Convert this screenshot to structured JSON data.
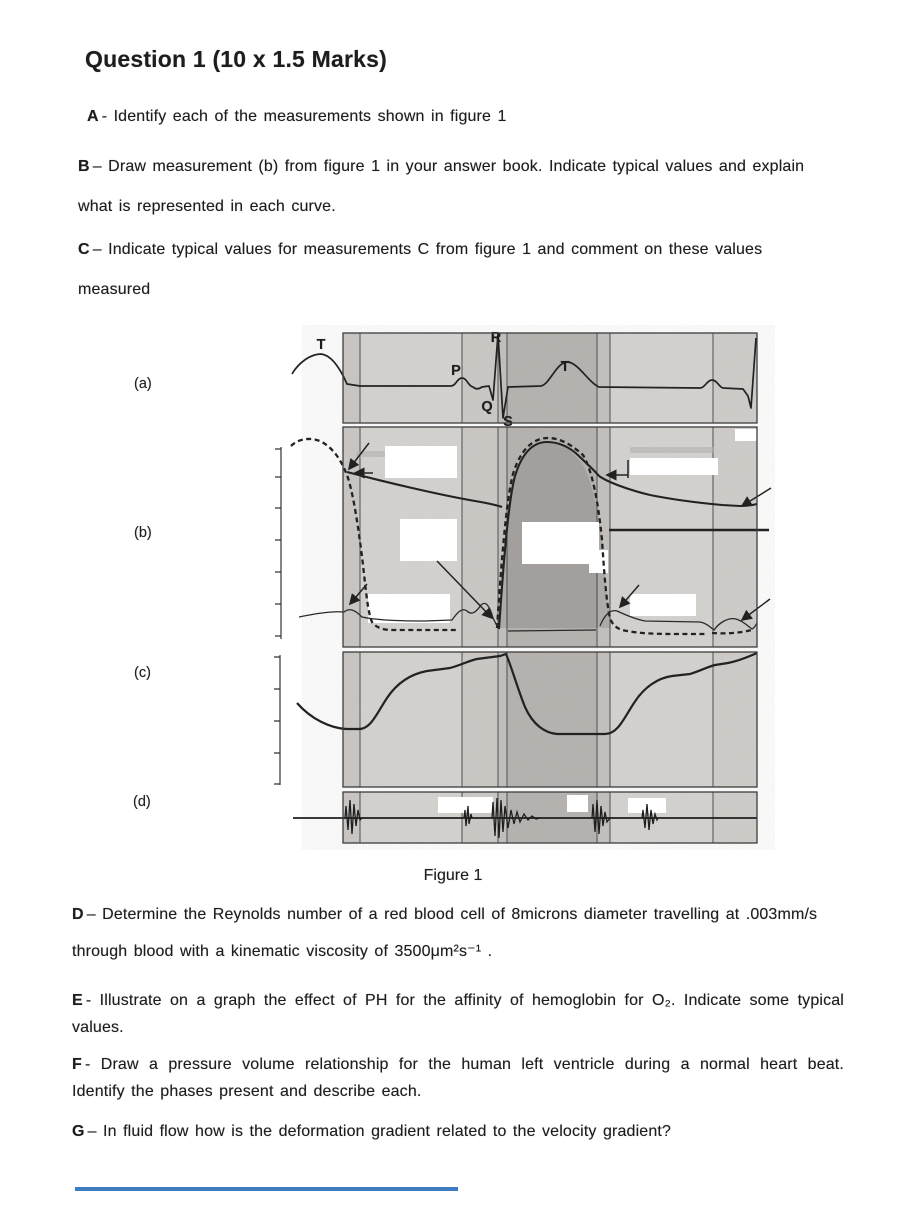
{
  "doc": {
    "title": "Question 1 (10 x 1.5 Marks)",
    "parts": {
      "a": {
        "label": "A",
        "text": "- Identify each of the measurements shown in figure 1"
      },
      "b": {
        "label": "B",
        "line1": "– Draw measurement (b) from figure 1 in your answer book. Indicate typical values and explain",
        "line2": "what is represented in each curve."
      },
      "c": {
        "label": "C",
        "line1": "– Indicate typical values for measurements C from figure 1 and comment on these values",
        "line2": "measured"
      },
      "d": {
        "label": "D",
        "line1": "– Determine the Reynolds number of a red blood cell of 8microns diameter travelling at .003mm/s",
        "line2": "through blood with a kinematic viscosity of 3500μm²s⁻¹ ."
      },
      "e": {
        "label": "E",
        "line1": "- Illustrate on a graph the effect of PH for the affinity of hemoglobin for O₂. Indicate some typical",
        "line2": "values."
      },
      "f": {
        "label": "F",
        "line1": "- Draw a pressure volume relationship for the human left ventricle during a normal heart beat.",
        "line2": "Identify the phases present and describe each."
      },
      "g": {
        "label": "G",
        "text": "– In fluid flow how is the deformation gradient related to the velocity gradient?"
      }
    }
  },
  "figure": {
    "caption": "Figure 1",
    "panels": [
      {
        "label": "(a)",
        "content": "ECG trace with P, QRS and T waves over two cardiac cycles"
      },
      {
        "label": "(b)",
        "content": "aortic, ventricular and atrial pressure curves; text labels whited out"
      },
      {
        "label": "(c)",
        "content": "ventricular volume curve; text labels whited out"
      },
      {
        "label": "(d)",
        "content": "phonocardiogram heart-sound bursts; text labels whited out"
      }
    ],
    "ecg": {
      "t_prev": "T",
      "p": "P",
      "q": "Q",
      "r": "R",
      "s": "S",
      "t": "T"
    },
    "colors": {
      "panel_bg": "#d7d5d2",
      "band_dark": "#b7b4b1",
      "band_mid": "#cdcac7",
      "trace": "#222222",
      "erased_box": "#ffffff"
    }
  },
  "footer": {
    "rule_color": "#3f7dc3",
    "rule_style": "background:#3f7dc3"
  }
}
